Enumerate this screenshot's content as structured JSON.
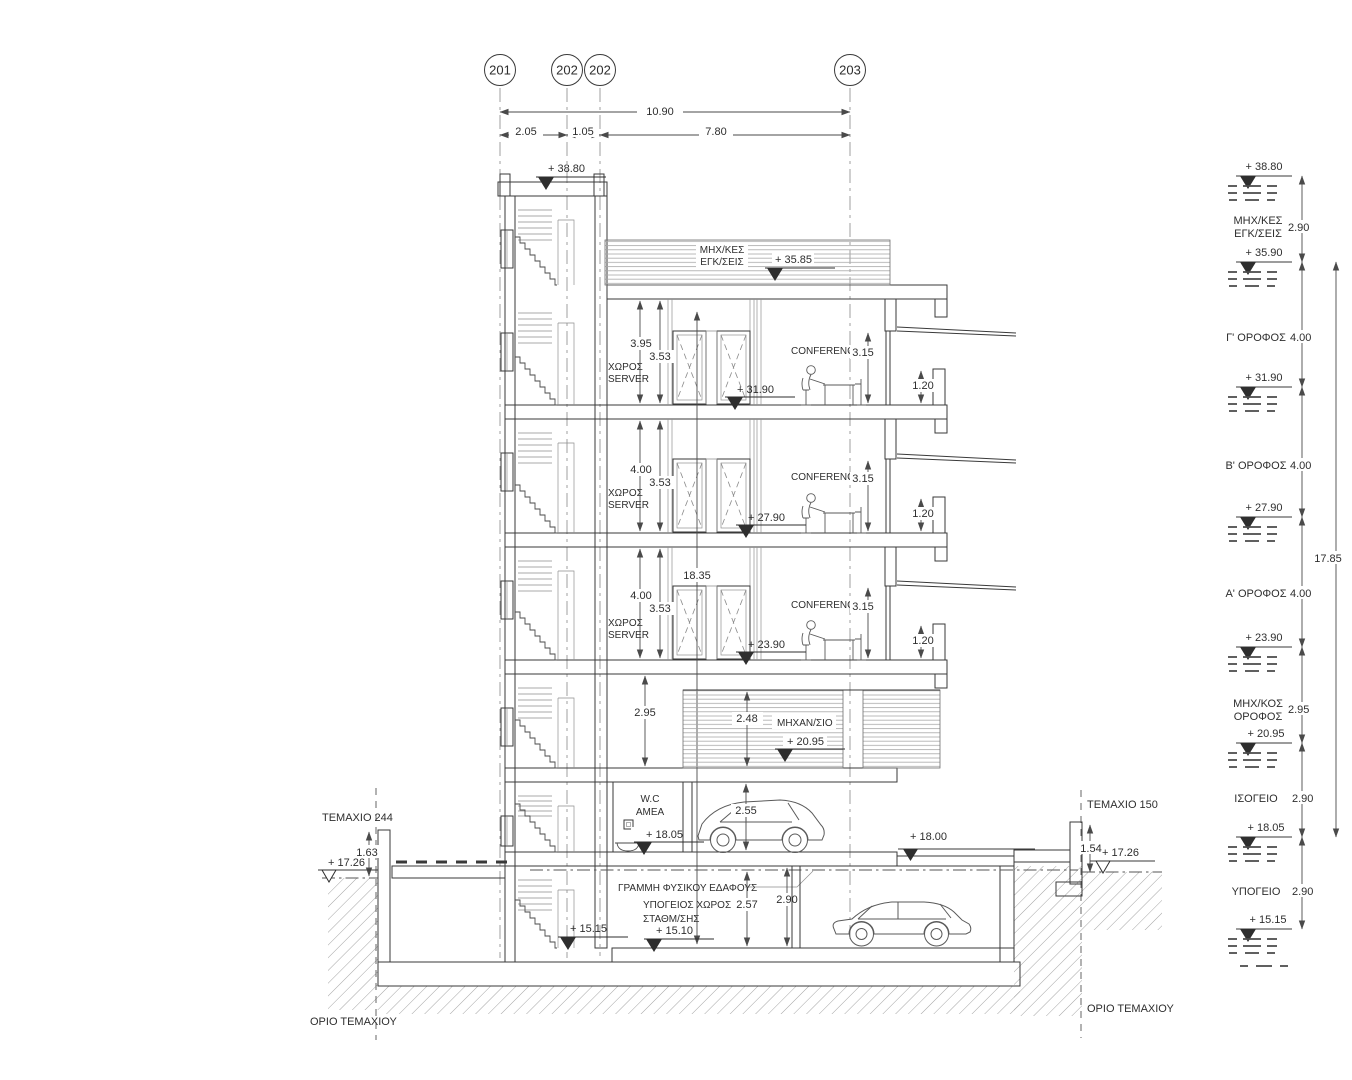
{
  "title": "Building cross-section drawing",
  "grid": {
    "bubbles": [
      "201",
      "202",
      "202",
      "203"
    ]
  },
  "top_dims": {
    "total": "10.90",
    "a": "2.05",
    "b": "1.05",
    "c": "7.80"
  },
  "roof": {
    "stair_level": "+ 38.80",
    "plant1": "ΜΗΧ/ΚΕΣ",
    "plant2": "ΕΓΚ/ΣΕΙΣ",
    "plant_level": "+ 35.85"
  },
  "floors": [
    {
      "h": "3.95",
      "w": "3.53",
      "room1": "ΧΩΡΟΣ",
      "room2": "SERVER",
      "conf": "CONFERENCE",
      "conf_h": "3.15",
      "level": "+ 31.90",
      "parapet": "1.20"
    },
    {
      "h": "4.00",
      "w": "3.53",
      "room1": "ΧΩΡΟΣ",
      "room2": "SERVER",
      "conf": "CONFERENCE",
      "conf_h": "3.15",
      "level": "+ 27.90",
      "parapet": "1.20"
    },
    {
      "h": "4.00",
      "w": "3.53",
      "room1": "ΧΩΡΟΣ",
      "room2": "SERVER",
      "conf": "CONFERENCE",
      "conf_h": "3.15",
      "level": "+ 23.90",
      "parapet": "1.20",
      "shaft": "18.35"
    }
  ],
  "mech": {
    "h_left": "2.95",
    "h_mid": "2.48",
    "room": "ΜΗΧΑΝ/ΣΙΟ",
    "level": "+ 20.95"
  },
  "ground": {
    "wc1": "W.C",
    "wc2": "AMEA",
    "level": "+ 18.05",
    "car_dim": "2.55",
    "terrace_level": "+ 18.00",
    "ground_line": "ΓΡΑΜΜΗ ΦΥΣΙΚΟΥ ΕΔΑΦΟΥΣ"
  },
  "basement": {
    "room1": "ΥΠΟΓΕΙΟΣ ΧΩΡΟΣ",
    "room2": "ΣΤΑΘΜ/ΣΗΣ",
    "level": "+ 15.10",
    "stair_level": "+ 15.15",
    "dim1": "2.57",
    "dim2": "2.90"
  },
  "site": {
    "left": {
      "plot": "TEMAXIO 244",
      "wall_dim": "1.63",
      "ground_level": "+ 17.26",
      "boundary": "ΟΡΙΟ ΤΕΜΑΧΙΟΥ"
    },
    "right": {
      "plot": "TEMAXIO 150",
      "wall_dim": "1.54",
      "ground_level": "+ 17.26",
      "boundary": "ΟΡΙΟ ΤΕΜΑΧΙΟΥ"
    }
  },
  "legend": {
    "total": "17.85",
    "levels": [
      "+ 38.80",
      "+ 35.90",
      "+ 31.90",
      "+ 27.90",
      "+ 23.90",
      "+ 20.95",
      "+ 18.05",
      "+ 15.15"
    ],
    "storeys": [
      {
        "n1": "ΜΗΧ/ΚΕΣ",
        "n2": "ΕΓΚ/ΣΕΙΣ",
        "h": "2.90"
      },
      {
        "n1": "Γ' ΟΡΟΦΟΣ",
        "h": "4.00"
      },
      {
        "n1": "Β' ΟΡΟΦΟΣ",
        "h": "4.00"
      },
      {
        "n1": "Α' ΟΡΟΦΟΣ",
        "h": "4.00"
      },
      {
        "n1": "ΜΗΧ/ΚΟΣ",
        "n2": "ΟΡΟΦΟΣ",
        "h": "2.95"
      },
      {
        "n1": "ΙΣΟΓΕΙΟ",
        "h": "2.90"
      },
      {
        "n1": "ΥΠΟΓΕΙΟ",
        "h": "2.90"
      }
    ]
  },
  "colors": {
    "line": "#3a3a3a",
    "paper": "#ffffff"
  }
}
